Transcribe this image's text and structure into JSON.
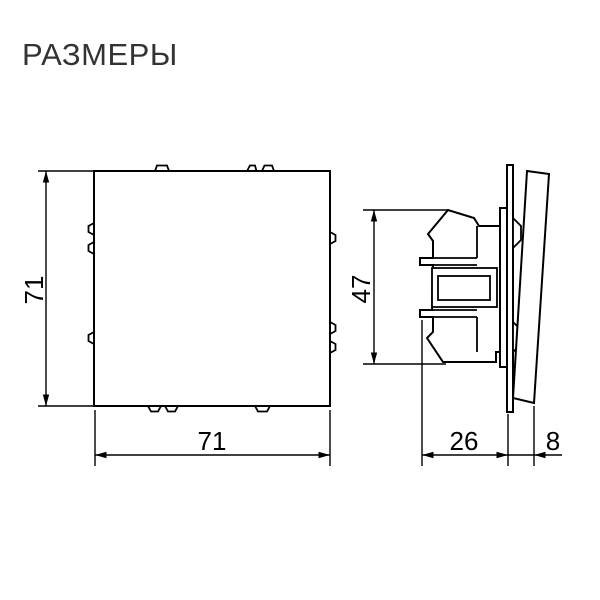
{
  "title": "РАЗМЕРЫ",
  "colors": {
    "background": "#ffffff",
    "line": "#000000",
    "title_text": "#333333",
    "dim_text": "#000000"
  },
  "front_view": {
    "height_dim": "71",
    "width_dim": "71"
  },
  "side_view": {
    "height_dim": "47",
    "depth_dim": "26",
    "key_depth_dim": "8"
  }
}
